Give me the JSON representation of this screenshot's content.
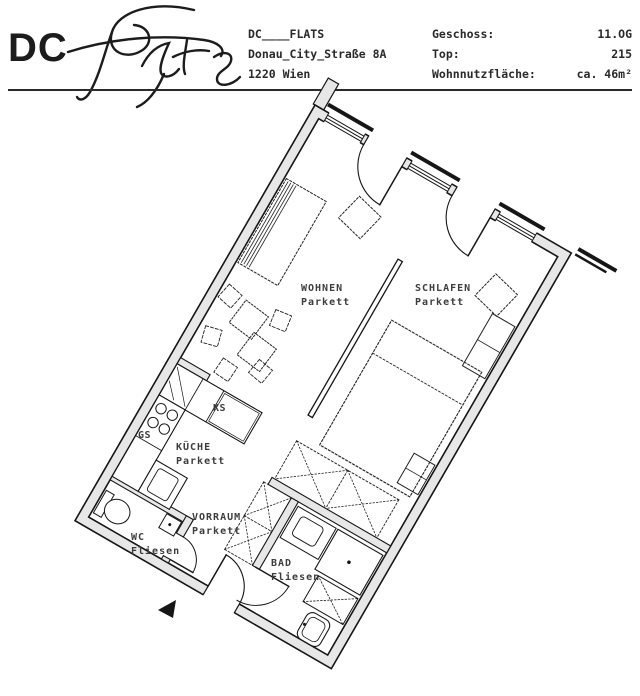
{
  "header": {
    "logo_text": "DC",
    "logo_script": "Flats",
    "address_lines": [
      "DC____FLATS",
      "Donau_City_Straße 8A",
      "1220 Wien"
    ],
    "info": [
      {
        "label": "Geschoss:",
        "value": "11.OG"
      },
      {
        "label": "Top:",
        "value": "215"
      },
      {
        "label": "Wohnnutzfläche:",
        "value": "ca. 46m²"
      }
    ]
  },
  "floorplan": {
    "rotation_deg": 30,
    "rooms": {
      "wohnen": {
        "name": "WOHNEN",
        "floor": "Parkett"
      },
      "schlafen": {
        "name": "SCHLAFEN",
        "floor": "Parkett"
      },
      "kueche": {
        "name": "KÜCHE",
        "floor": "Parkett"
      },
      "vorraum": {
        "name": "VORRAUM",
        "floor": "Parkett"
      },
      "wc": {
        "name": "WC",
        "floor": "Fliesen"
      },
      "bad": {
        "name": "BAD",
        "floor": "Fliesen"
      }
    },
    "appliances": {
      "fridge": "KS",
      "dishwasher": "GS"
    },
    "icons": {
      "entrance_arrow": "black triangle pointing to entrance door"
    },
    "colors": {
      "wall_fill": "#e7e7e7",
      "line": "#161616",
      "label": "#3d3d3d"
    }
  }
}
